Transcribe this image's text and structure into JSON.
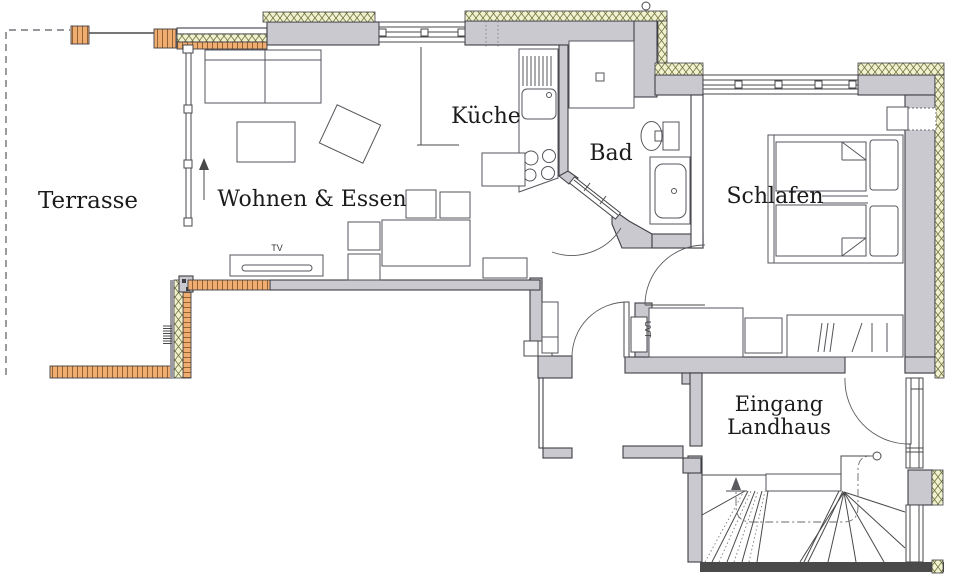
{
  "rooms": {
    "terrace": "Terrasse",
    "living": "Wohnen & Essen",
    "kitchen": "Küche",
    "bath": "Bad",
    "bedroom": "Schlafen",
    "entrance_line1": "Eingang",
    "entrance_line2": "Landhaus"
  },
  "small_labels": {
    "tv": "TV",
    "uvt": "UVT"
  },
  "colors": {
    "wall": "#c9c9cf",
    "wall_stroke": "#3f3f46",
    "insulation_fill": "#f0f2cf",
    "insulation_hatch": "#70703d",
    "deck_fill": "#efad72",
    "deck_stripe": "#8a5a28",
    "line": "#4a4a4a",
    "text": "#1b1b1b",
    "background": "#ffffff"
  }
}
